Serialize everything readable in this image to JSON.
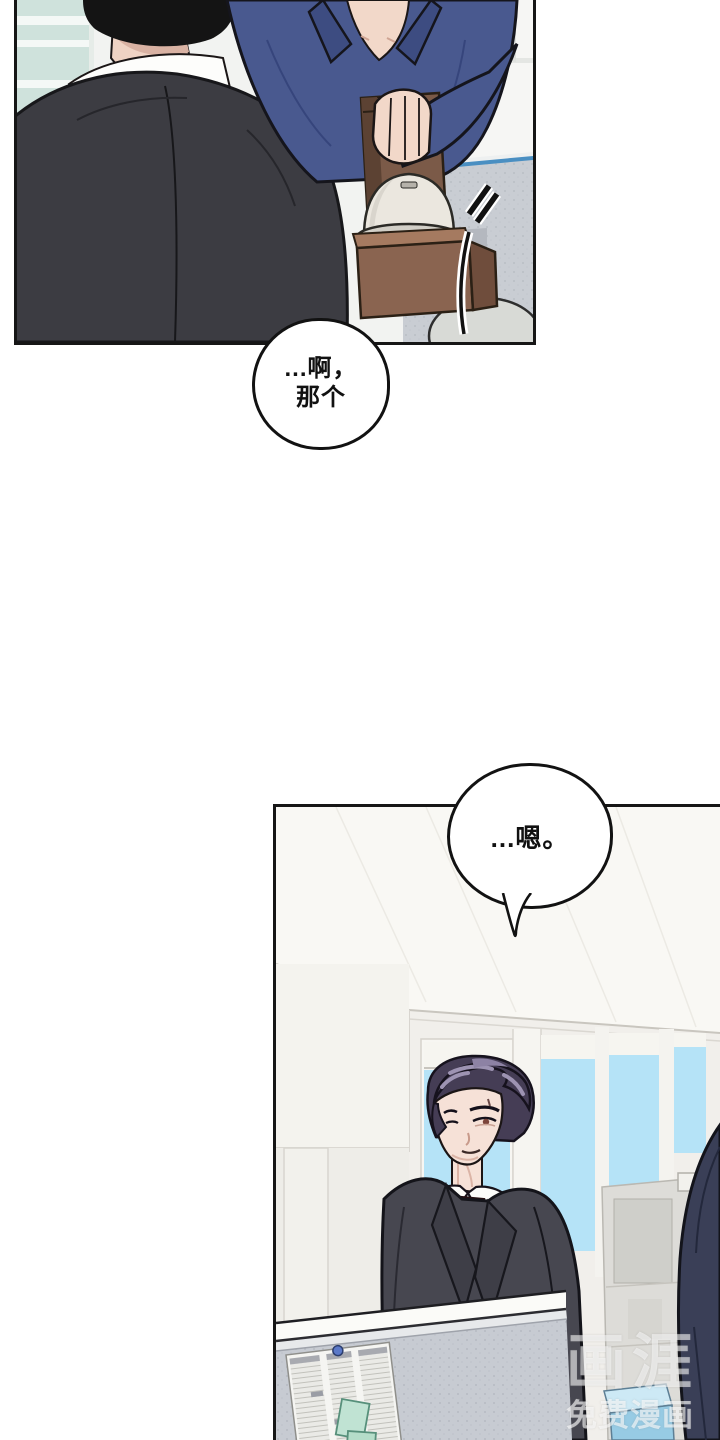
{
  "page": {
    "width": 720,
    "height": 1440,
    "background": "#ffffff",
    "kind": "webtoon-comic-page"
  },
  "panels": [
    {
      "id": "panel-1",
      "alt": "Office scene: man in dark suit seen from behind faces man in blue shirt holding a brown take-out carrier with a dome-lidded cup beside a cubicle partition"
    },
    {
      "id": "panel-2",
      "alt": "Office scene: stern man with dark purple hair, white shirt, dark red tie and dark suit stands by bright windows; cubicle partition with pinned schedule and sticky notes in front"
    }
  ],
  "speech_bubbles": [
    {
      "id": "bubble-1",
      "lines": [
        "...啊，",
        "那个"
      ]
    },
    {
      "id": "bubble-2",
      "lines": [
        "...嗯。"
      ]
    }
  ],
  "watermark": {
    "logo": "画涯",
    "caption": "免费漫画"
  },
  "palette": {
    "panel_border": "#161616",
    "shirt_blue": "#49598f",
    "suit_dark_back": "#3c3c42",
    "suit_gray": "#474750",
    "tie_red": "#8e3a3a",
    "hair_purple": "#453d55",
    "hair_highlight": "#9d93b2",
    "sky_blue": "#b5e3f7",
    "partition_gray": "#c7cbd2",
    "partition_cap_blue": "#4a8fc2",
    "carrier_brown": "#8a6450",
    "cup_cream": "#ebe7df",
    "sticky_note_mint": "#bfe2d2",
    "skin": "#f2d8c9"
  }
}
